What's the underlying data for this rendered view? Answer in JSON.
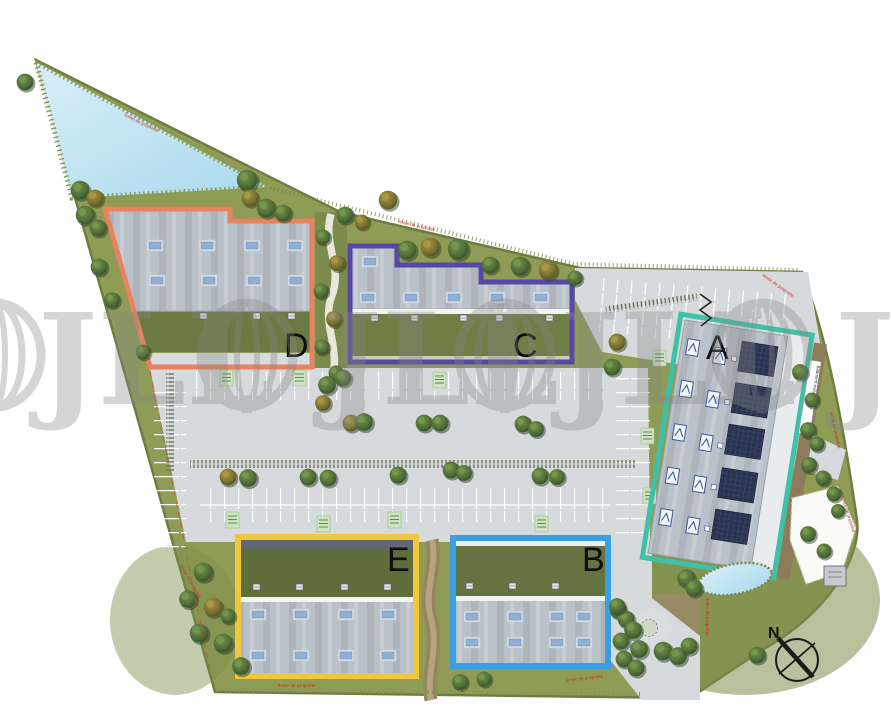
{
  "watermark": {
    "brand": "JLL"
  },
  "site_plan": {
    "buildings": [
      {
        "label": "A",
        "outline_color": "#3fc0a8"
      },
      {
        "label": "B",
        "outline_color": "#3b9fdf"
      },
      {
        "label": "C",
        "outline_color": "#5747a6"
      },
      {
        "label": "D",
        "outline_color": "#e8825f"
      },
      {
        "label": "E",
        "outline_color": "#f1c83d"
      }
    ],
    "compass": {
      "label": "N"
    },
    "annotations": {
      "boundary": "limite de propriété",
      "building_a_side": "Bâtiment existant"
    }
  }
}
